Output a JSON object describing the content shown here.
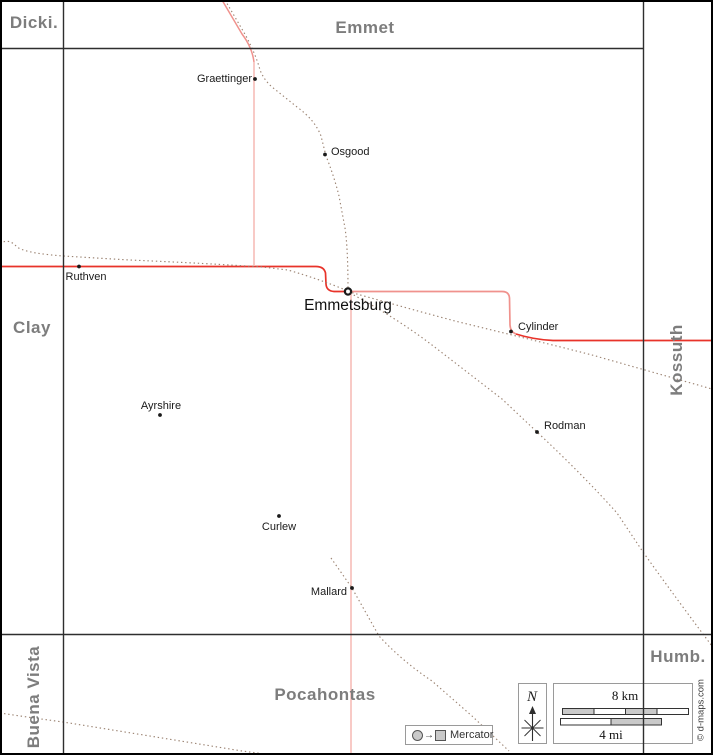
{
  "counties": {
    "dickinson": {
      "label": "Dicki."
    },
    "emmet": {
      "label": "Emmet"
    },
    "clay": {
      "label": "Clay"
    },
    "kossuth": {
      "label": "Kossuth"
    },
    "buena_vista": {
      "label": "Buena Vista"
    },
    "pocahontas": {
      "label": "Pocahontas"
    },
    "humboldt": {
      "label": "Humb."
    }
  },
  "towns": {
    "graettinger": {
      "name": "Graettinger"
    },
    "osgood": {
      "name": "Osgood"
    },
    "ruthven": {
      "name": "Ruthven"
    },
    "emmetsburg": {
      "name": "Emmetsburg",
      "marker": "county-seat-ring"
    },
    "cylinder": {
      "name": "Cylinder"
    },
    "ayrshire": {
      "name": "Ayrshire"
    },
    "rodman": {
      "name": "Rodman"
    },
    "curlew": {
      "name": "Curlew"
    },
    "mallard": {
      "name": "Mallard"
    }
  },
  "legend": {
    "north_label": "N",
    "scale_km": "8 km",
    "scale_mi": "4 mi",
    "projection": "Mercator",
    "projection_arrow": "→",
    "copyright": "© d-maps.com"
  },
  "colors": {
    "county_border": "#2e2e2e",
    "neighbor_label": "#7d7d7d",
    "road_primary": "#e8332a",
    "road_secondary": "#f0928d",
    "road_minor": "#f6bcb8",
    "railroad": "#9b8372",
    "town_dot": "#1a1a1a",
    "scale_fill": "#c9c9c9"
  }
}
